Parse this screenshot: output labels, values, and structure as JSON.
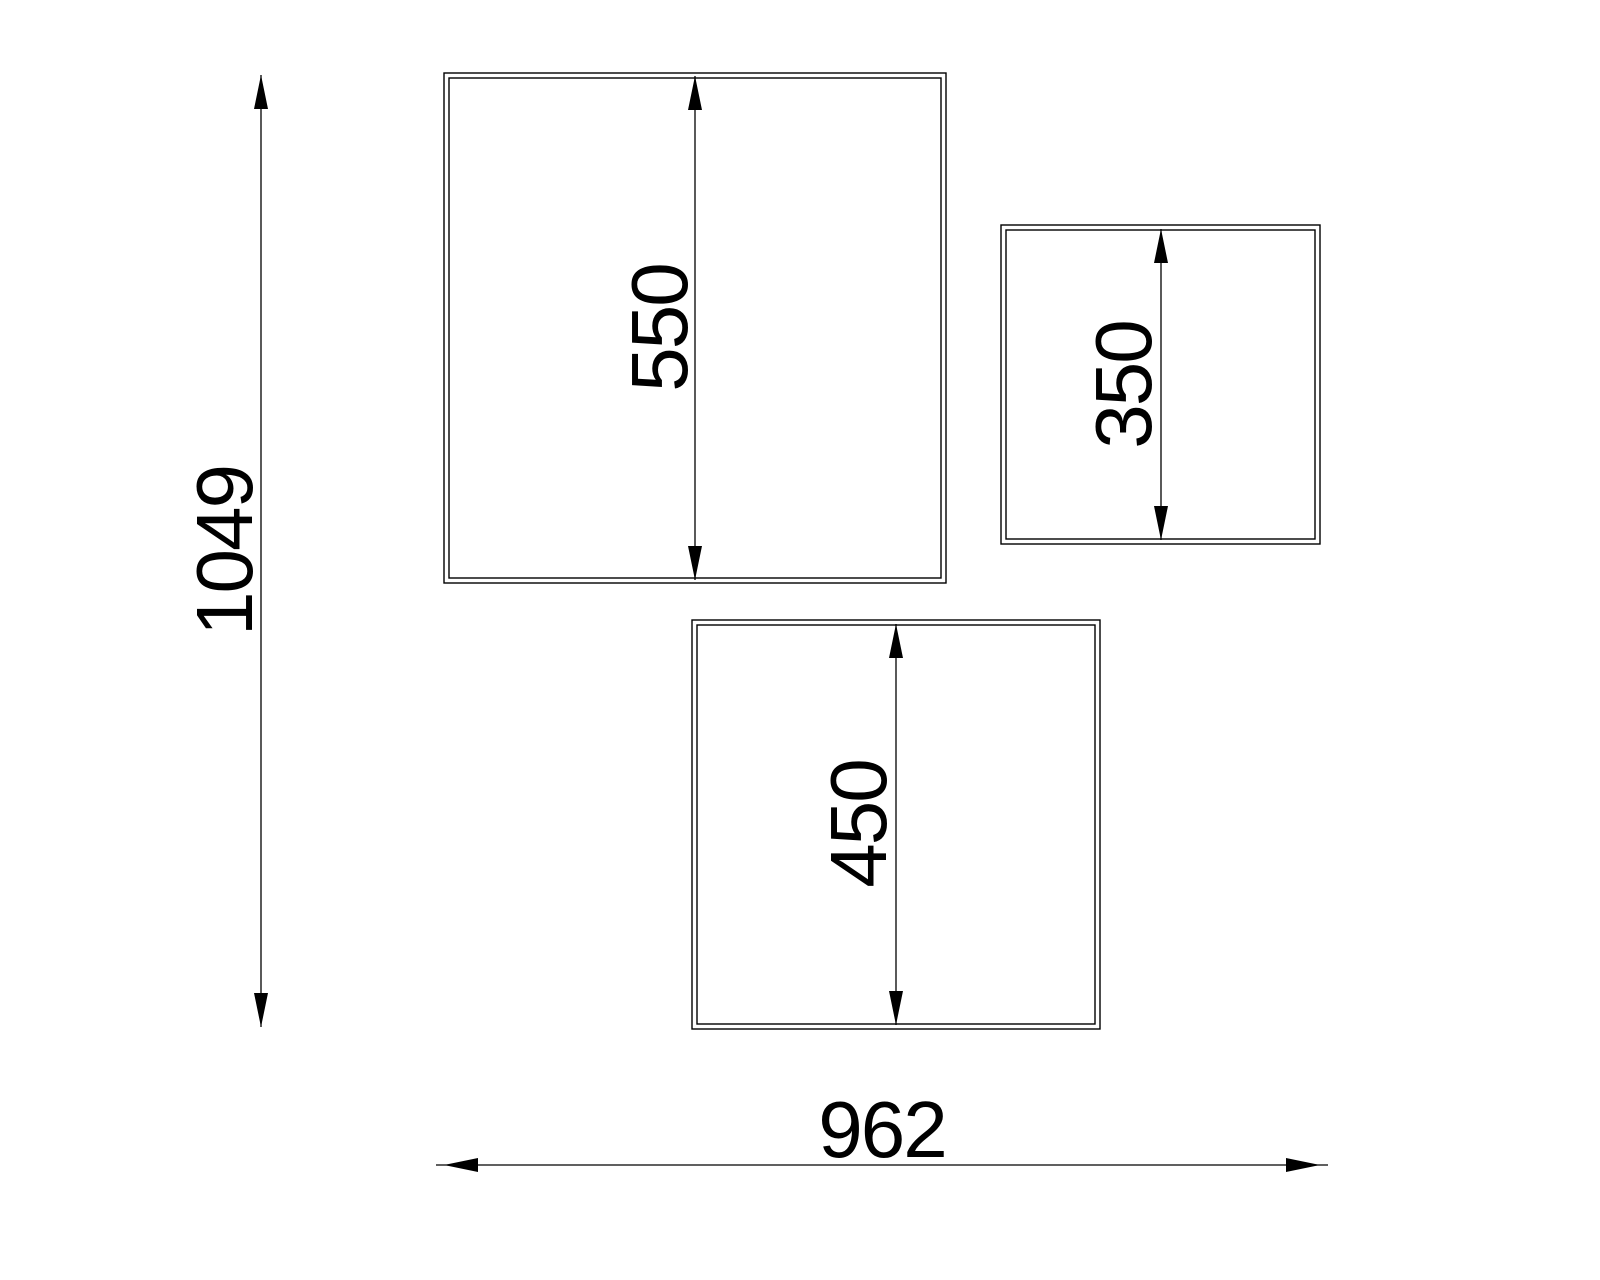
{
  "colors": {
    "background": "#ffffff",
    "lines": "#000000",
    "text": "#000000"
  },
  "panels": [
    {
      "name": "large-panel",
      "height_dim": "550"
    },
    {
      "name": "small-panel",
      "height_dim": "350"
    },
    {
      "name": "medium-panel",
      "height_dim": "450"
    }
  ],
  "overall": {
    "height_dim": "1049",
    "width_dim": "962"
  }
}
